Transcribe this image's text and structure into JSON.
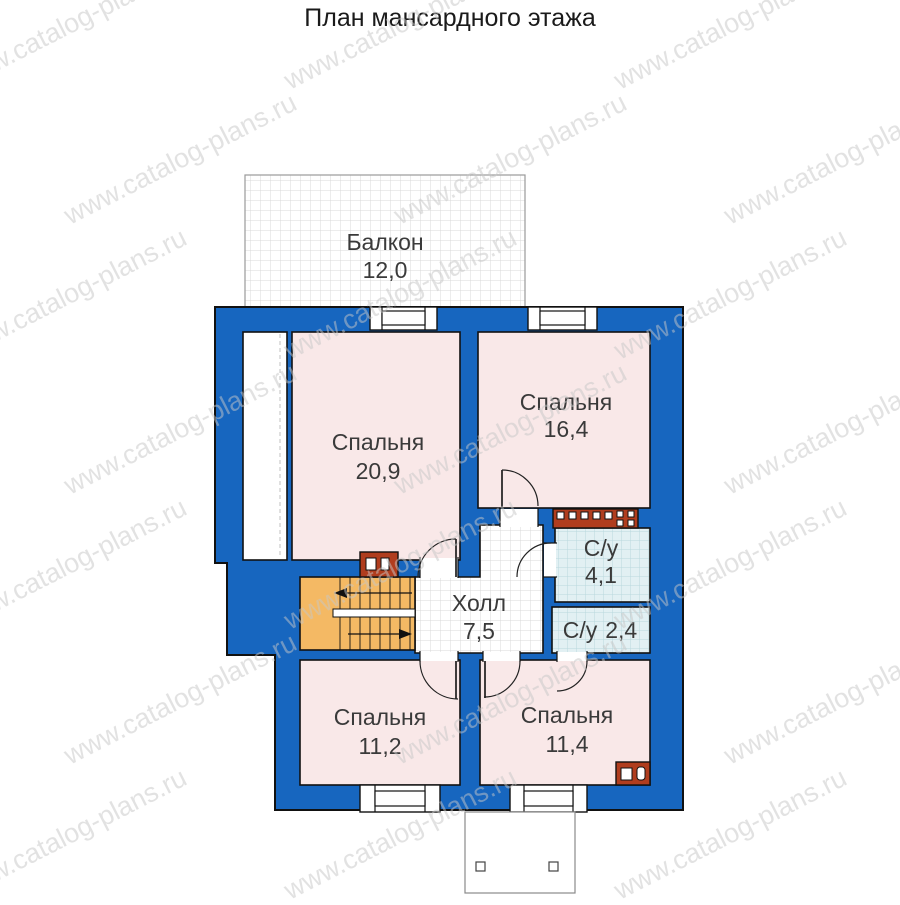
{
  "title": "План мансардного этажа",
  "watermark_text": "www.catalog-plans.ru",
  "colors": {
    "wall_blue": "#1766bf",
    "room_pink": "#f9e8e8",
    "bath_tile": "#e2f0f3",
    "stairs_orange": "#f4b964",
    "vent_red": "#b03d1e",
    "watermark_gray": "#c7c7c7"
  },
  "rooms": {
    "balcony": {
      "name": "Балкон",
      "area": "12,0"
    },
    "bedroom_main": {
      "name": "Спальня",
      "area": "20,9"
    },
    "bedroom_right": {
      "name": "Спальня",
      "area": "16,4"
    },
    "bath_main": {
      "name": "С/у",
      "area": "4,1"
    },
    "bath_small": {
      "name": "С/у",
      "area": "2,4"
    },
    "hall": {
      "name": "Холл",
      "area": "7,5"
    },
    "bedroom_bottom_left": {
      "name": "Спальня",
      "area": "11,2"
    },
    "bedroom_bottom_right": {
      "name": "Спальня",
      "area": "11,4"
    }
  }
}
